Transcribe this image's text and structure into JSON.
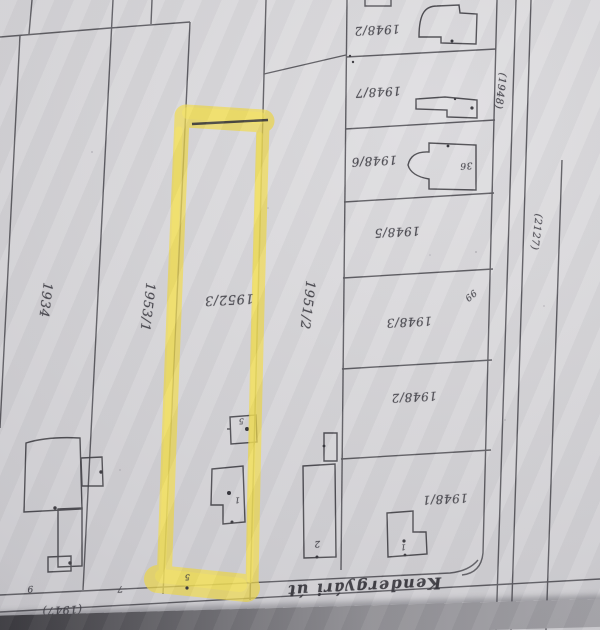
{
  "map": {
    "type": "cadastral-sketch-photo",
    "orientation": "upside-down",
    "highlighted_parcel": "1952/3",
    "street_name": "Kendergyári út",
    "highlight_color": "#f0da4e",
    "paper_color": "#d6d5d8",
    "pencil_color": "#4e4d53"
  },
  "labels": [
    {
      "text": "1934"
    },
    {
      "text": "1953/1"
    },
    {
      "text": "1952/3"
    },
    {
      "text": "1951/2"
    },
    {
      "text": "1948/2"
    },
    {
      "text": "1948/7"
    },
    {
      "text": "1948/6"
    },
    {
      "text": "1948/5"
    },
    {
      "text": "1948/3"
    },
    {
      "text": "1948/2"
    },
    {
      "text": "1948/1"
    },
    {
      "text": "Kendergyári út"
    },
    {
      "text": "(1947)"
    },
    {
      "text": "(1941)"
    },
    {
      "text": "(1948)"
    },
    {
      "text": "(2127)"
    },
    {
      "text": "36"
    },
    {
      "text": "99"
    },
    {
      "text": "2"
    },
    {
      "text": "5"
    },
    {
      "text": "1"
    },
    {
      "text": "9"
    },
    {
      "text": "7"
    },
    {
      "text": "5"
    },
    {
      "text": "1"
    }
  ]
}
